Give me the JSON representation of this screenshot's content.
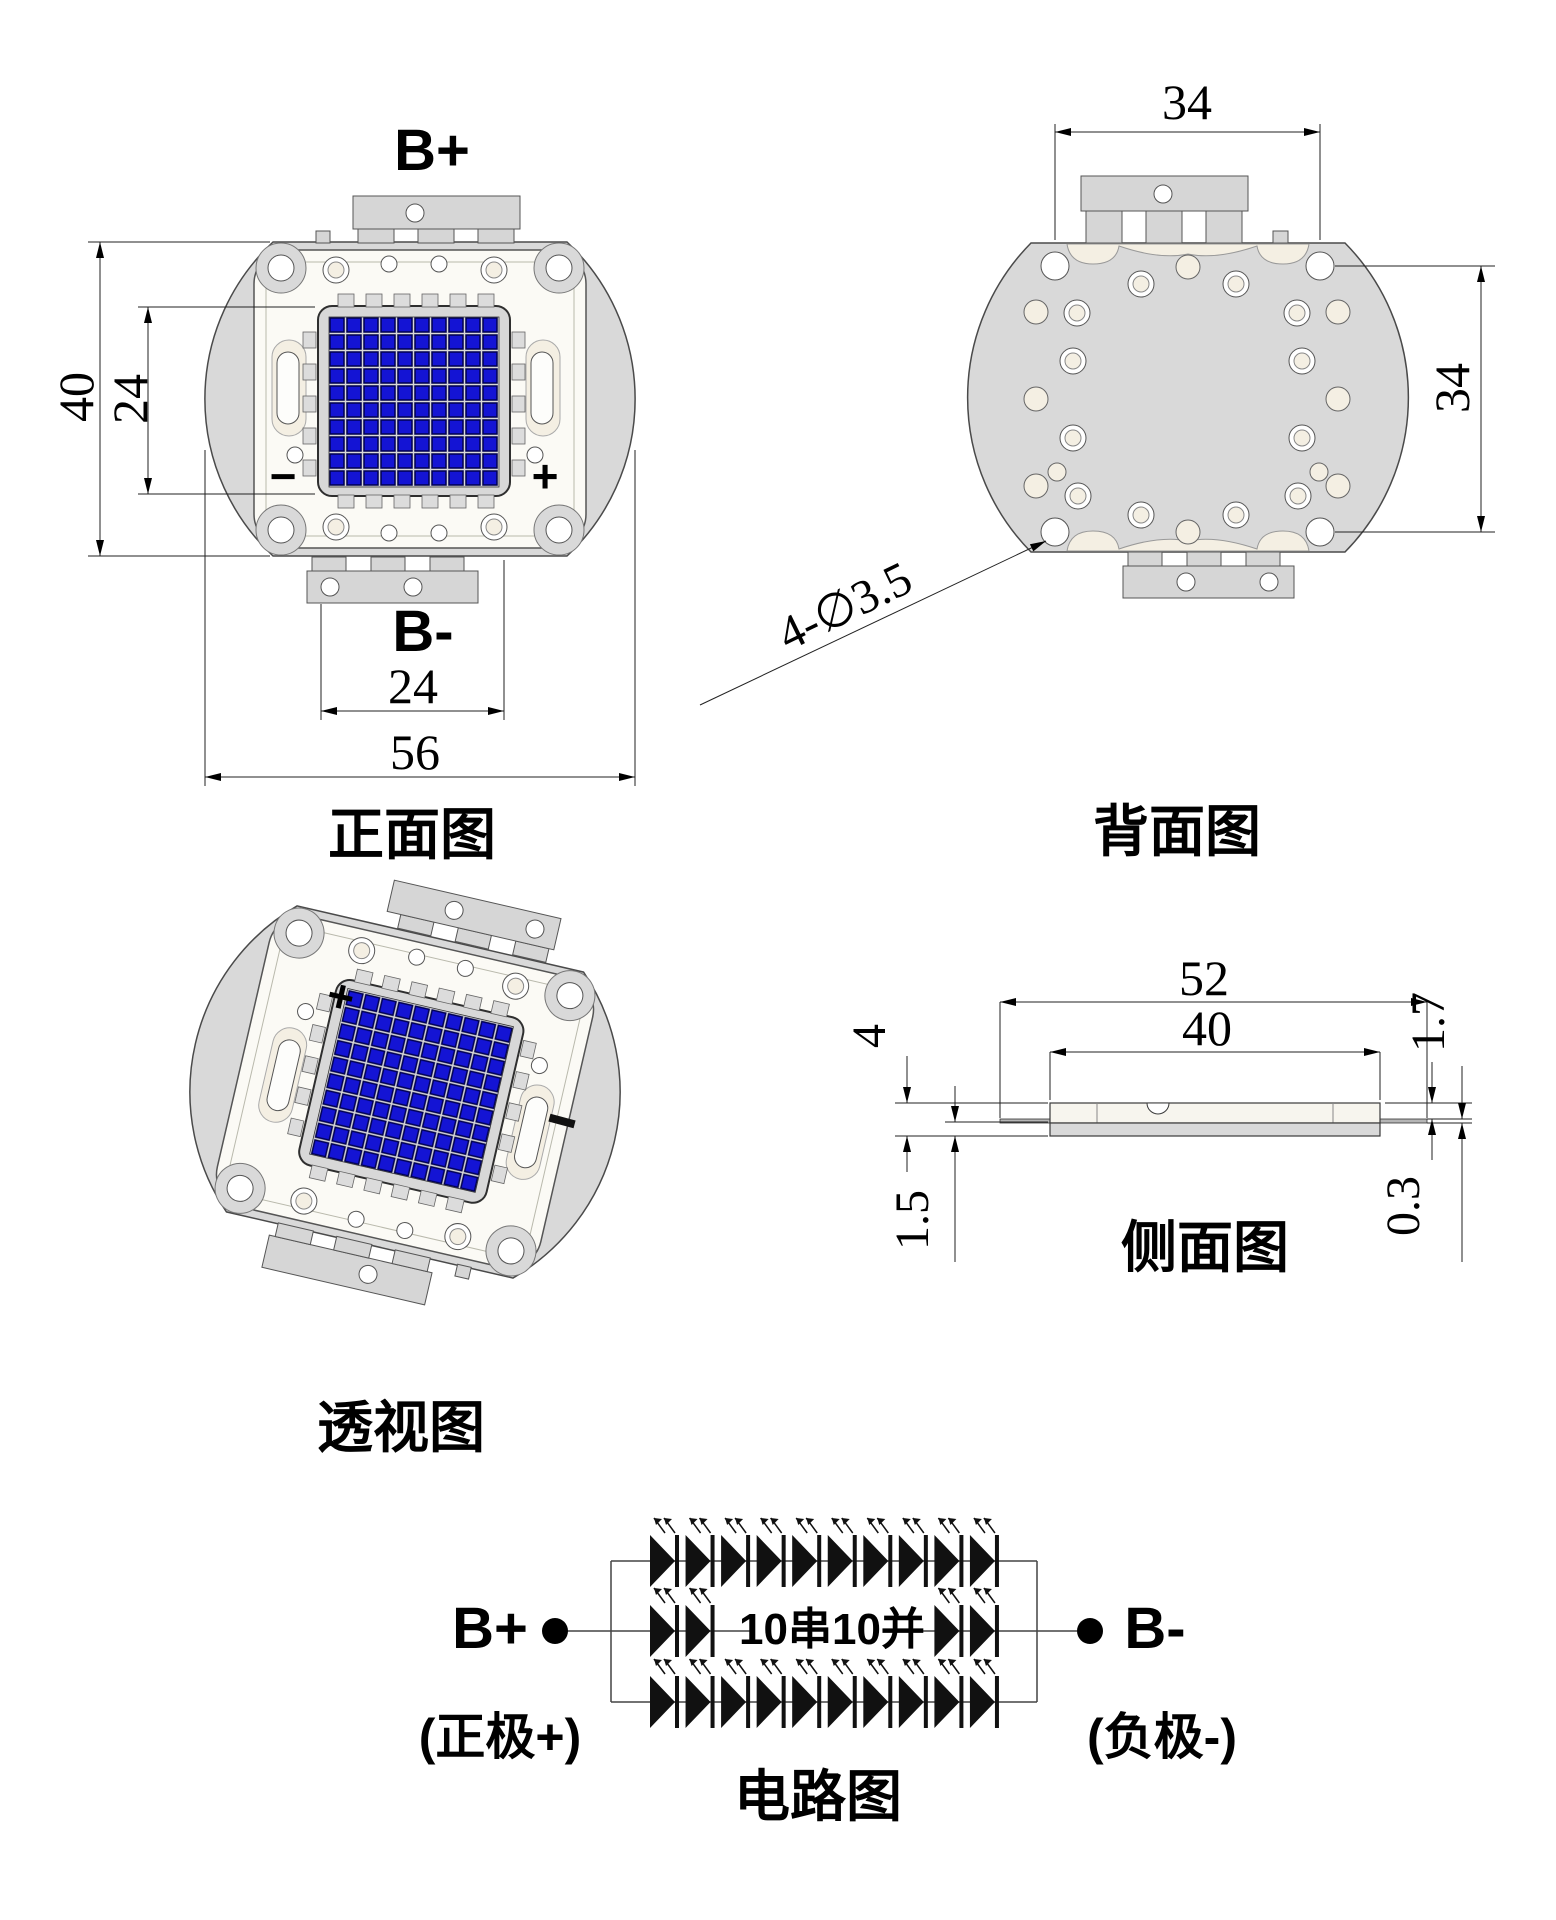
{
  "front": {
    "b_plus": "B+",
    "b_minus": "B-",
    "neg_mark": "−",
    "pos_mark": "+",
    "dim_height": "40",
    "dim_led_height": "24",
    "dim_led_width": "24",
    "dim_width": "56",
    "title": "正面图"
  },
  "back": {
    "dim_top": "34",
    "dim_right": "34",
    "holes_note": "4-∅3.5",
    "title": "背面图"
  },
  "perspective": {
    "pos_mark": "+",
    "title": "透视图"
  },
  "side": {
    "dim_total_length": "52",
    "dim_body_length": "40",
    "dim_height": "4",
    "dim_base_thickness": "1.5",
    "dim_step_height": "1.7",
    "dim_lead_thickness": "0.3",
    "title": "侧面图"
  },
  "circuit": {
    "b_plus": "B+",
    "b_minus": "B-",
    "config": "10串10并",
    "anode_label": "(正极+)",
    "cathode_label": "(负极-)",
    "title": "电路图"
  },
  "colors": {
    "led_blue": "#1414d4",
    "body_gray": "#d9d9d9",
    "cream": "#f4efe3"
  }
}
